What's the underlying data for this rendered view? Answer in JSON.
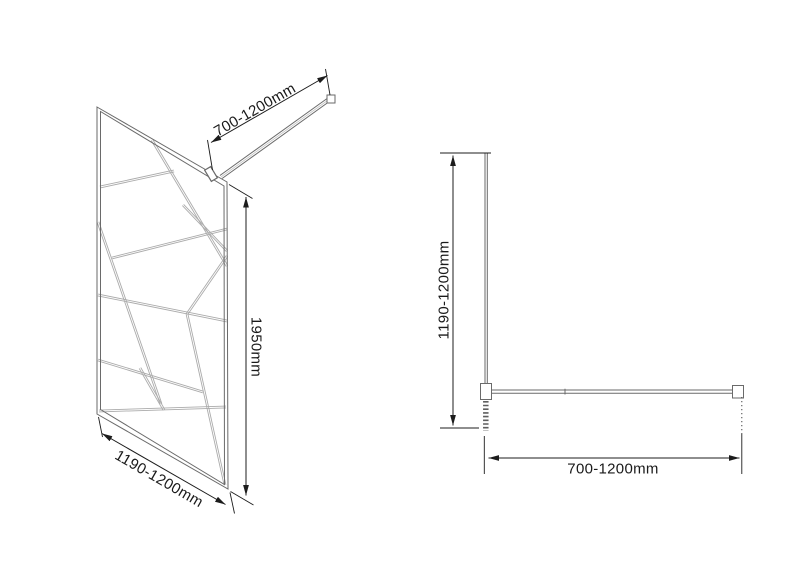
{
  "perspective_view": {
    "bar_length_label": "700-1200mm",
    "height_label": "1950mm",
    "width_label": "1190-1200mm"
  },
  "plan_view": {
    "height_label": "1190-1200mm",
    "width_label": "700-1200mm"
  },
  "colors": {
    "background": "#ffffff",
    "outline": "#6a6a6a",
    "pattern": "#ababab",
    "mid": "#c4c4c4",
    "hatch": "#5f5f5f",
    "dim": "#1c1c1c",
    "text": "#1a1a1a"
  },
  "geometry": {
    "panel_outer": "97,107 227,182 228,489 97,414",
    "panel_inner": "100.5,111.5 224,186 224.5,484.5 100.5,409.5",
    "pattern": [
      [
        152,
        140,
        227,
        266
      ],
      [
        100,
        187,
        174,
        171
      ],
      [
        183,
        205,
        227,
        251
      ],
      [
        98,
        222,
        161,
        404
      ],
      [
        98,
        295,
        227,
        321
      ],
      [
        227,
        256,
        187,
        314
      ],
      [
        187,
        314,
        225,
        485
      ],
      [
        99,
        411,
        226,
        407
      ],
      [
        112,
        258,
        227,
        229
      ],
      [
        98,
        360,
        203,
        392
      ],
      [
        140,
        368,
        164,
        410
      ]
    ],
    "outline_lines": [
      [
        222.1,
        178.5,
        332.1,
        99.5
      ],
      [
        219.9,
        175.5,
        329.9,
        96.5
      ],
      [
        485,
        153,
        485,
        400
      ],
      [
        487.3,
        153,
        487.3,
        400
      ],
      [
        491.5,
        390,
        733,
        390
      ],
      [
        491.5,
        393.2,
        733,
        393.2
      ],
      [
        565,
        388.8,
        565,
        394.5
      ]
    ],
    "mid_line": [
      221,
      177,
      331,
      98
    ],
    "rects": [
      [
        327,
        95,
        8,
        8
      ],
      [
        480.5,
        383.5,
        11,
        16
      ],
      [
        732.5,
        385.5,
        11,
        12.5
      ]
    ],
    "clamp": {
      "cx": 211,
      "cy": 174,
      "w": 7,
      "h": 13,
      "angle": -31
    },
    "hatch": {
      "x": 485.8,
      "y1": 401,
      "y2": 431,
      "width": 5.5
    },
    "ext_lines": [
      [
        212.5,
        170,
        207.5,
        140
      ],
      [
        330,
        95,
        325.5,
        69
      ],
      [
        229,
        184.5,
        252.5,
        198.5
      ],
      [
        230.5,
        491.5,
        253.5,
        505
      ],
      [
        98.5,
        417,
        102.5,
        437
      ],
      [
        230,
        492.5,
        234.5,
        513.5
      ],
      [
        440,
        153,
        491,
        153
      ],
      [
        440,
        428,
        479,
        428
      ],
      [
        484.3,
        436,
        484.3,
        474
      ],
      [
        741.8,
        434,
        741.8,
        474
      ]
    ],
    "dotted_lines": [
      [
        741.8,
        397,
        741.8,
        434
      ]
    ],
    "dim_lines": [
      [
        211,
        142.5,
        327.5,
        75.5
      ],
      [
        246,
        197,
        246,
        495.5
      ],
      [
        102,
        433.5,
        225.5,
        504.5
      ],
      [
        453,
        155.5,
        453,
        425.5
      ],
      [
        488.5,
        458,
        739.5,
        458
      ]
    ]
  }
}
